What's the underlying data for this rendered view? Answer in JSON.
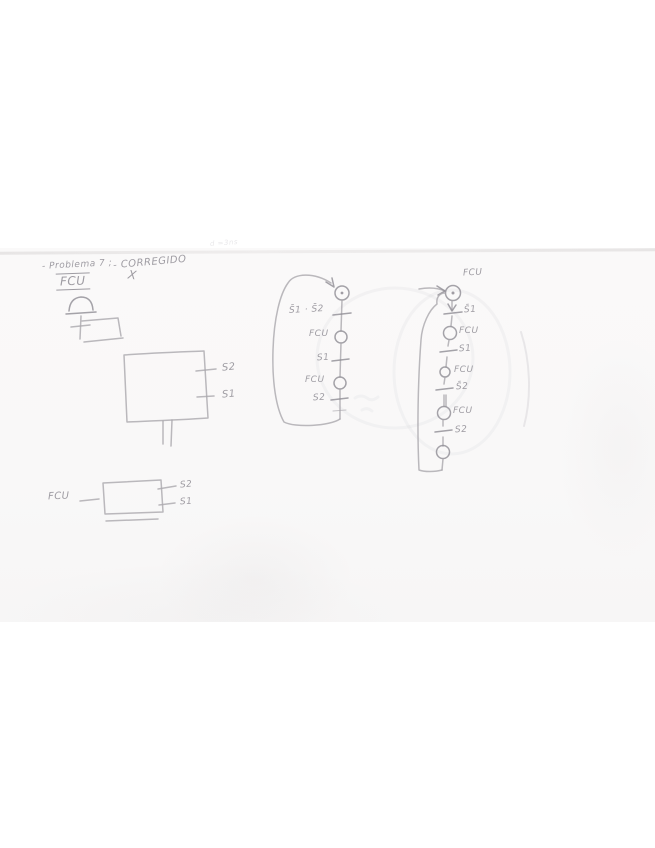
{
  "colors": {
    "paper": "#f9f8f8",
    "pencil": "#aaa7ad",
    "pencil_dark": "#8f8c94",
    "pencil_faint": "#c9c6cb",
    "crease": "#e7e5e5"
  },
  "header": {
    "problem": "- Problema 7 ;",
    "corrected": "- CORREGIDO",
    "mark": "X",
    "fcu": "FCU"
  },
  "ghost_note": "d =3ns",
  "big_box": {
    "side_top": "S2",
    "side_bottom": "S1"
  },
  "small_box": {
    "input": "FCU",
    "side_top": "S2",
    "side_bottom": "S1"
  },
  "middle_chain": {
    "t1": "S̄1 · S̄2",
    "s1": "FCU",
    "t2": "S1",
    "s2": "FCU",
    "t3": "S2"
  },
  "right_chain": {
    "title": "FCU",
    "t1": "S̄1",
    "s1": "FCU",
    "t2": "S1",
    "s2": "FCU",
    "t3": "S̄2",
    "s3": "FCU",
    "t4": "S2"
  }
}
